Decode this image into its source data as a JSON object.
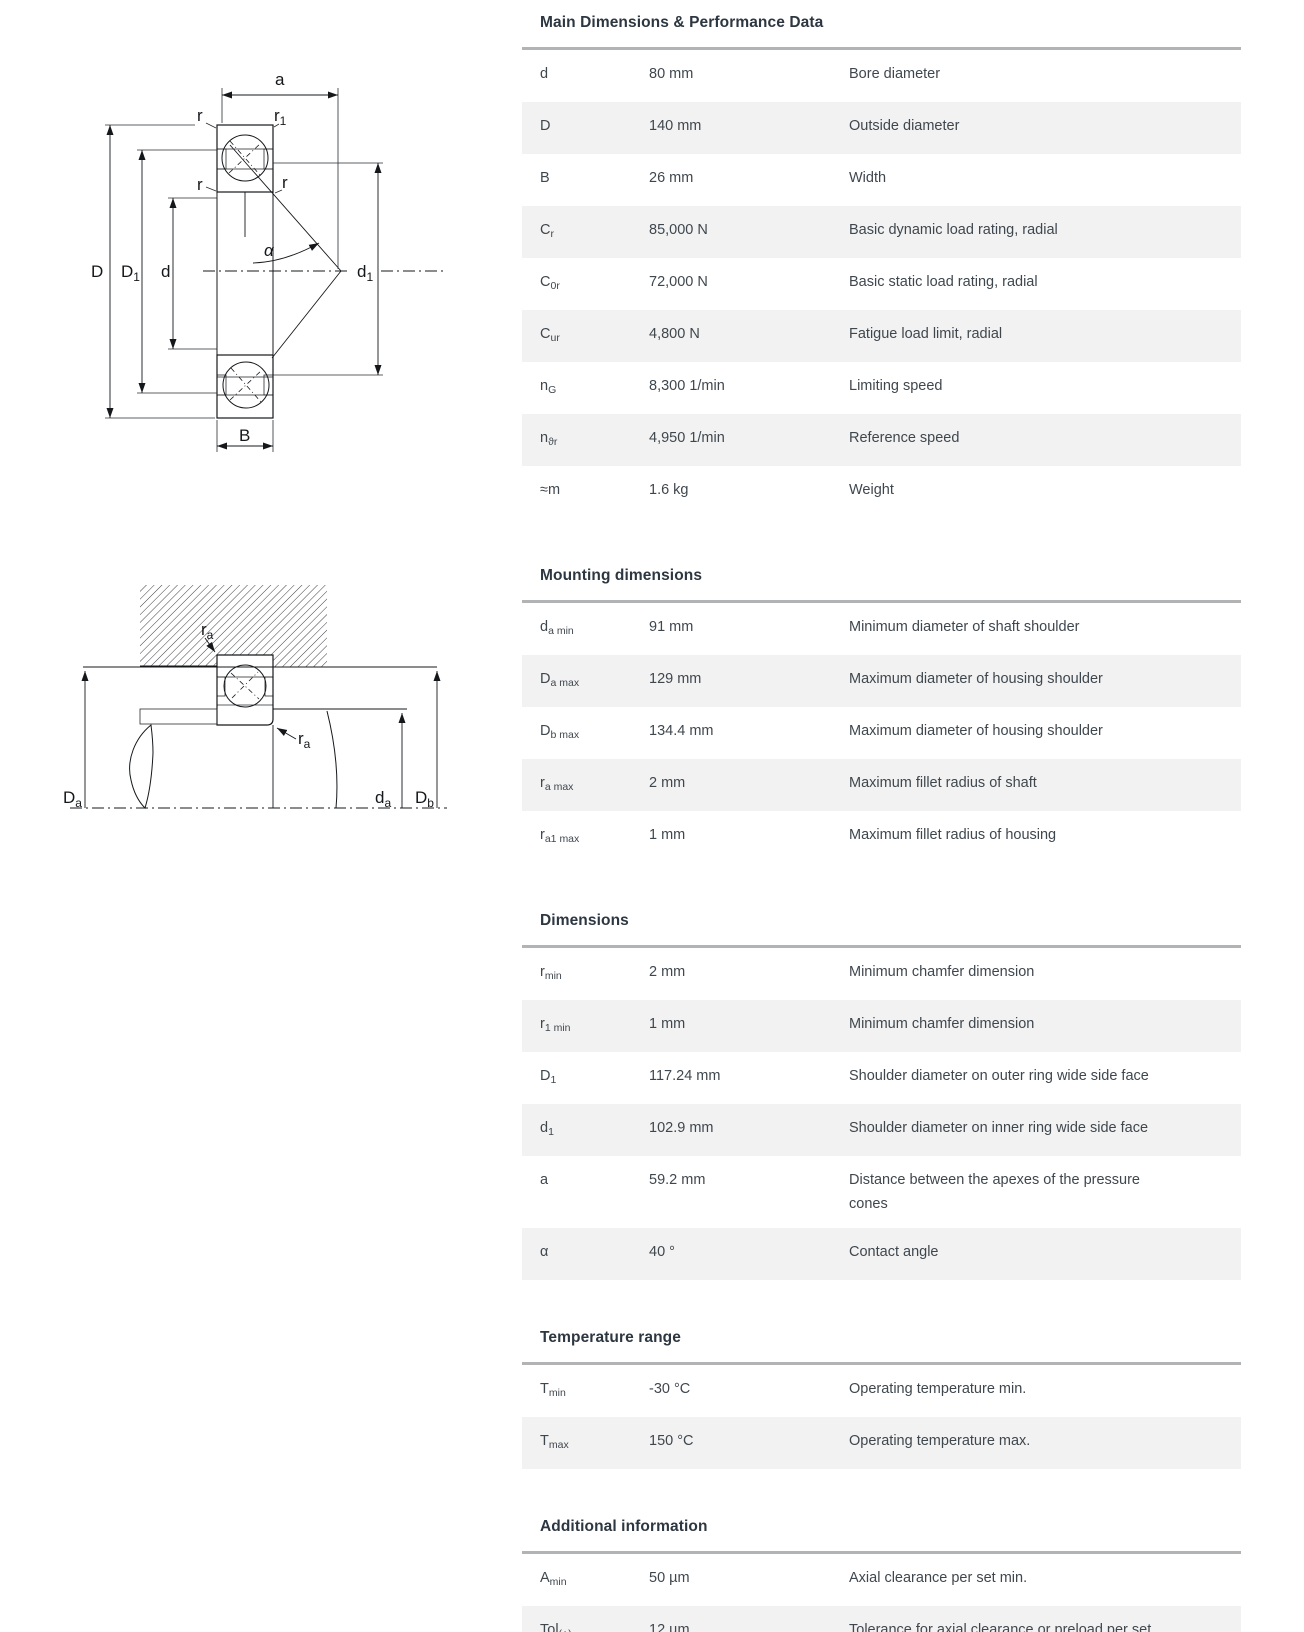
{
  "colors": {
    "background": "#ffffff",
    "section_title_text": "#2d3741",
    "row_text": "#3f474e",
    "row_stripe": "#f2f2f2",
    "divider": "#b1b3b5",
    "drawing_lines": "#15181b"
  },
  "diagrams": {
    "cross_section": {
      "labels": {
        "a": "a",
        "r": "r",
        "r1": {
          "base": "r",
          "sub": "1"
        },
        "alpha": "α",
        "D": "D",
        "D1": {
          "base": "D",
          "sub": "1"
        },
        "d": "d",
        "d1": {
          "base": "d",
          "sub": "1"
        },
        "B": "B"
      }
    },
    "mounting": {
      "labels": {
        "ra": {
          "base": "r",
          "sub": "a"
        },
        "Da": {
          "base": "D",
          "sub": "a"
        },
        "da": {
          "base": "d",
          "sub": "a"
        },
        "Db": {
          "base": "D",
          "sub": "b"
        }
      }
    }
  },
  "sections": [
    {
      "title": "Main Dimensions & Performance Data",
      "rows": [
        {
          "sym": "d",
          "sub": "",
          "value": "80 mm",
          "description": "Bore diameter"
        },
        {
          "sym": "D",
          "sub": "",
          "value": "140 mm",
          "description": "Outside diameter"
        },
        {
          "sym": "B",
          "sub": "",
          "value": "26 mm",
          "description": "Width"
        },
        {
          "sym": "C",
          "sub": "r",
          "value": "85,000 N",
          "description": "Basic dynamic load rating, radial"
        },
        {
          "sym": "C",
          "sub": "0r",
          "value": "72,000 N",
          "description": "Basic static load rating, radial"
        },
        {
          "sym": "C",
          "sub": "ur",
          "value": "4,800 N",
          "description": "Fatigue load limit, radial"
        },
        {
          "sym": "n",
          "sub": "G",
          "value": "8,300 1/min",
          "description": "Limiting speed"
        },
        {
          "sym": "n",
          "sub": "ϑr",
          "value": "4,950 1/min",
          "description": "Reference speed"
        },
        {
          "sym": "≈m",
          "sub": "",
          "value": "1.6 kg",
          "description": "Weight"
        }
      ]
    },
    {
      "title": "Mounting dimensions",
      "rows": [
        {
          "sym": "d",
          "sub": "a min",
          "value": "91 mm",
          "description": "Minimum diameter of shaft shoulder"
        },
        {
          "sym": "D",
          "sub": "a max",
          "value": "129 mm",
          "description": "Maximum diameter of housing shoulder"
        },
        {
          "sym": "D",
          "sub": "b max",
          "value": "134.4 mm",
          "description": "Maximum diameter of housing shoulder"
        },
        {
          "sym": "r",
          "sub": "a max",
          "value": "2 mm",
          "description": "Maximum fillet radius of shaft"
        },
        {
          "sym": "r",
          "sub": "a1 max",
          "value": "1 mm",
          "description": "Maximum fillet radius of housing"
        }
      ]
    },
    {
      "title": "Dimensions",
      "rows": [
        {
          "sym": "r",
          "sub": "min",
          "value": "2 mm",
          "description": "Minimum chamfer dimension"
        },
        {
          "sym": "r",
          "sub": "1 min",
          "value": "1 mm",
          "description": "Minimum chamfer dimension"
        },
        {
          "sym": "D",
          "sub": "1",
          "value": "117.24 mm",
          "description": "Shoulder diameter on outer ring wide side face"
        },
        {
          "sym": "d",
          "sub": "1",
          "value": "102.9 mm",
          "description": "Shoulder diameter on inner ring wide side face"
        },
        {
          "sym": "a",
          "sub": "",
          "value": "59.2 mm",
          "description": "Distance between the apexes of the pressure cones"
        },
        {
          "sym": "α",
          "sub": "",
          "value": "40 °",
          "description": "Contact angle"
        }
      ]
    },
    {
      "title": "Temperature range",
      "rows": [
        {
          "sym": "T",
          "sub": "min",
          "value": "-30 °C",
          "description": "Operating temperature min."
        },
        {
          "sym": "T",
          "sub": "max",
          "value": "150 °C",
          "description": "Operating temperature max."
        }
      ]
    },
    {
      "title": "Additional information",
      "rows": [
        {
          "sym": "A",
          "sub": "min",
          "value": "50 µm",
          "description": "Axial clearance per set min."
        },
        {
          "sym": "Tol",
          "sub": "(+)",
          "value": "12 µm",
          "description": "Tolerance for axial clearance or preload per set"
        }
      ]
    }
  ]
}
